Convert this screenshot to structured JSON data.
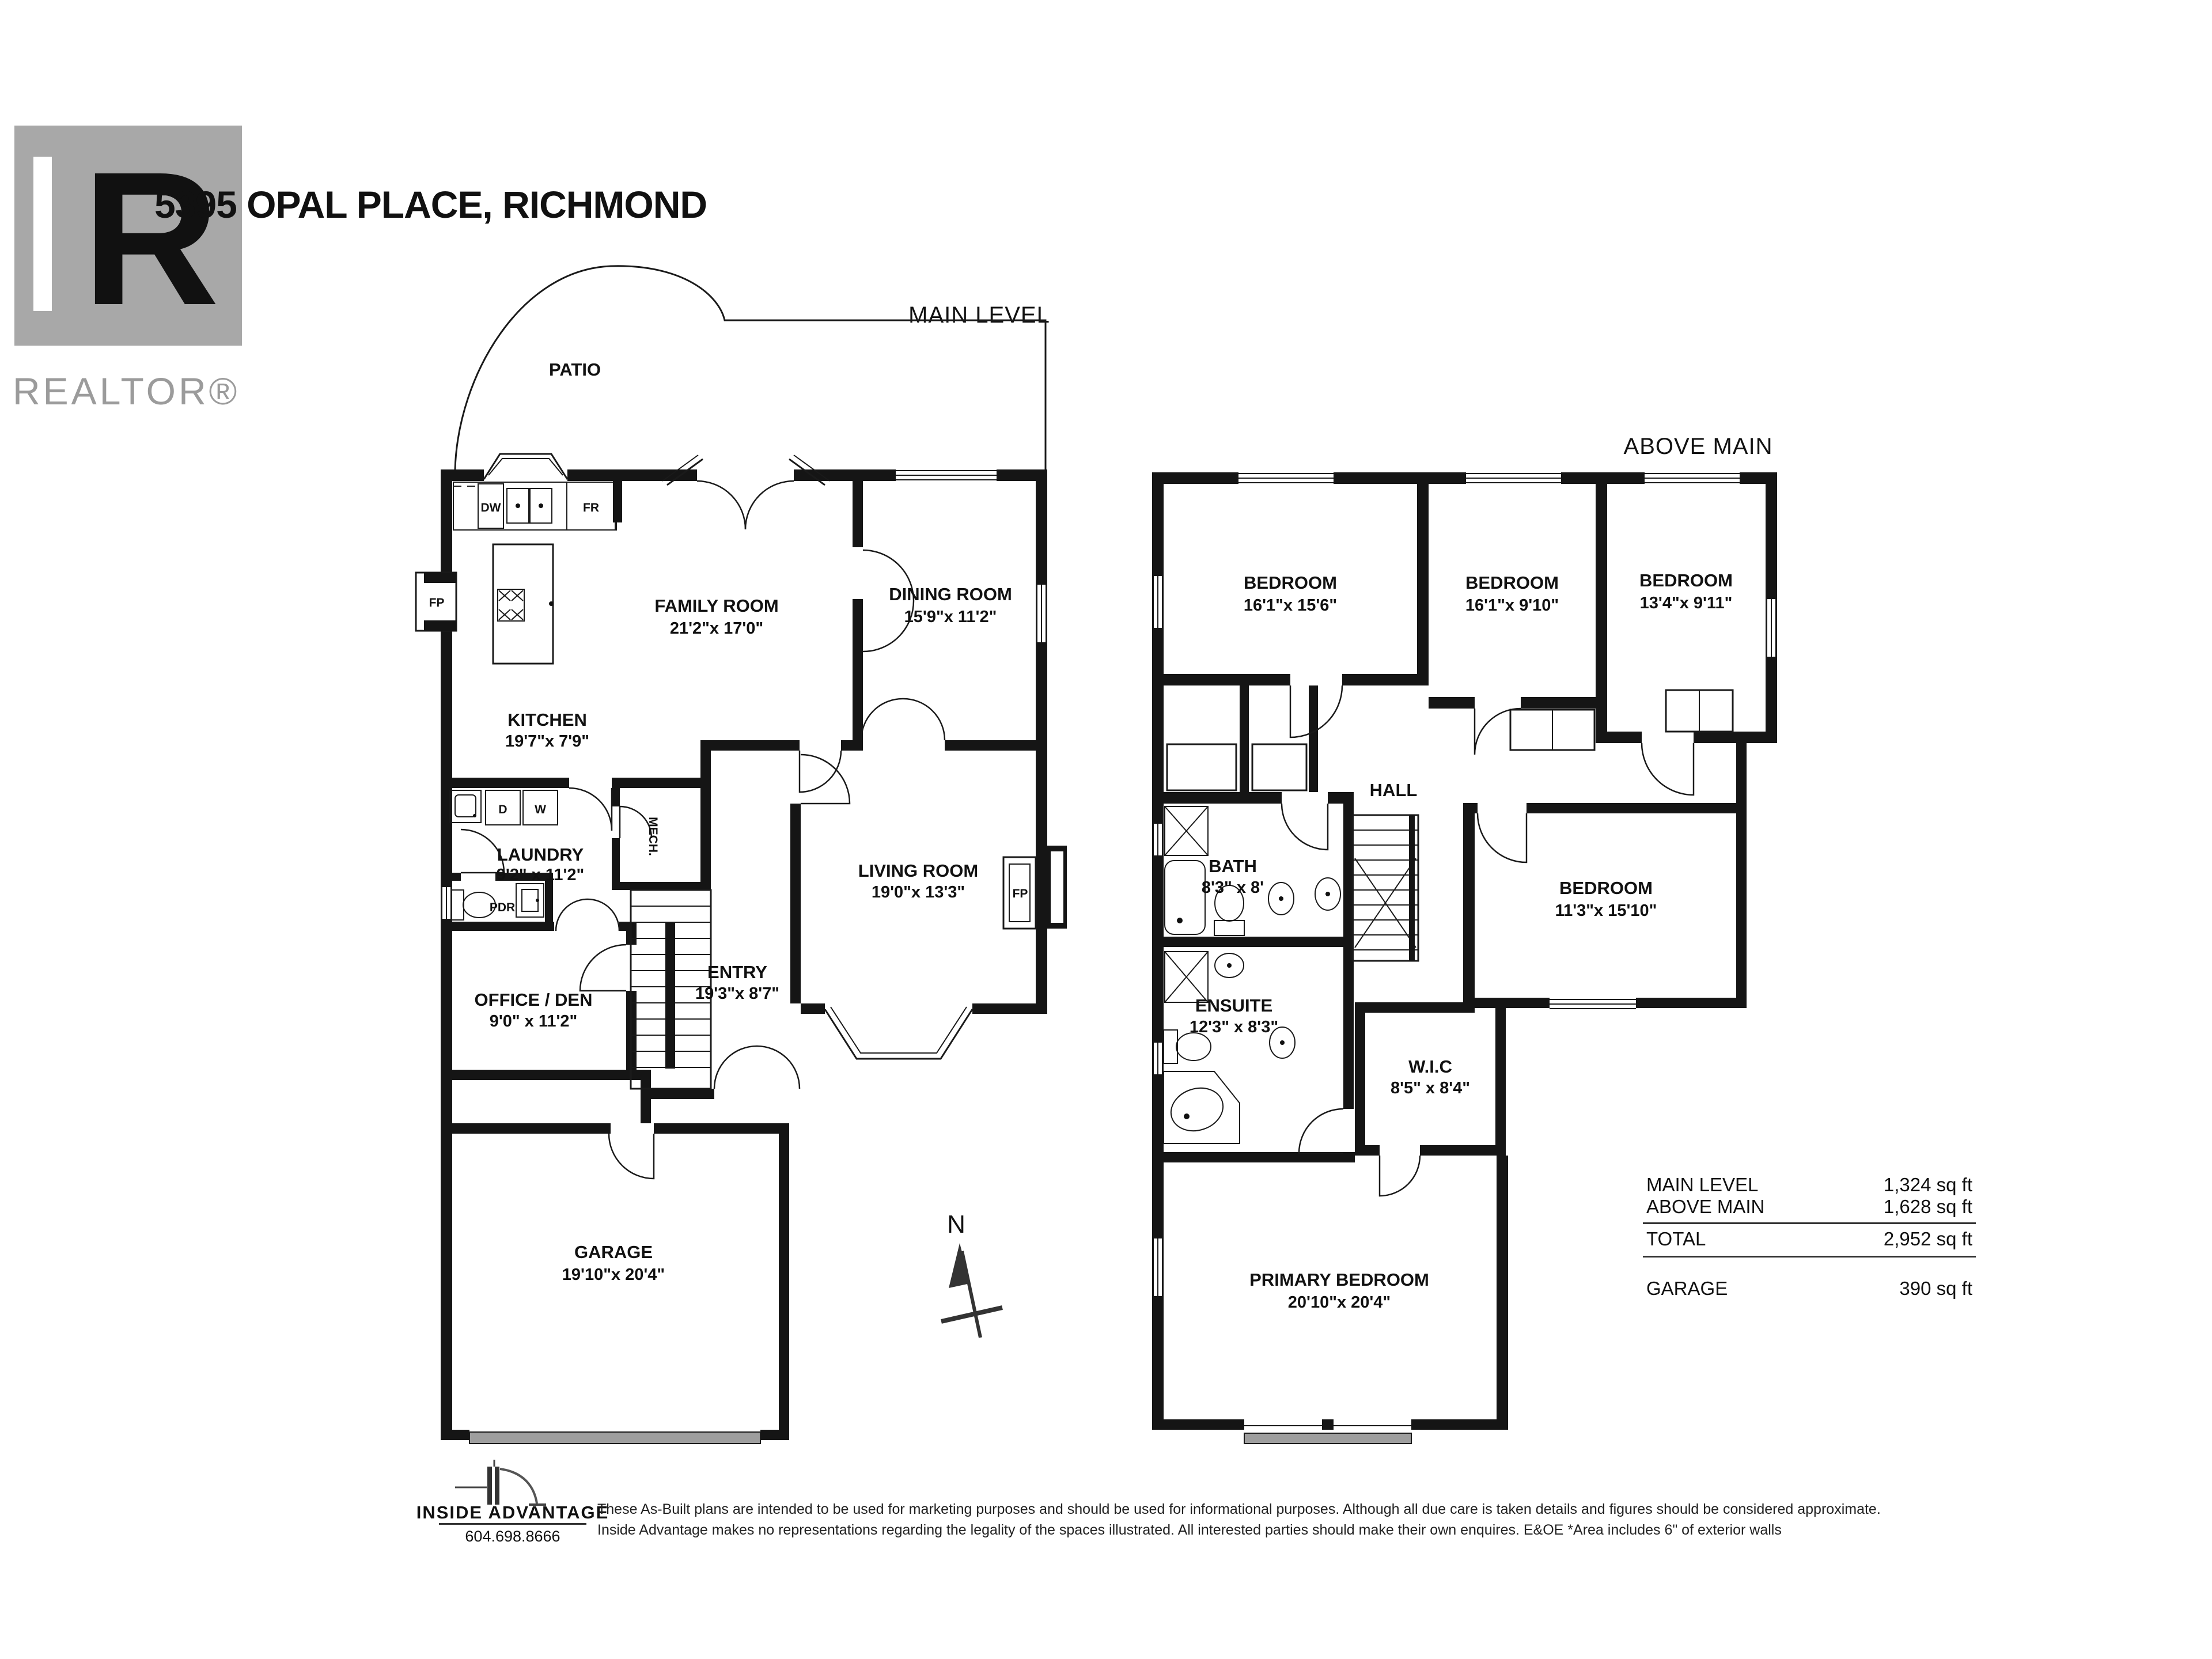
{
  "title": "5395 OPAL PLACE, RICHMOND",
  "realtor": {
    "letter": "R",
    "wordmark": "REALTOR®"
  },
  "main_level": {
    "label": "MAIN LEVEL",
    "patio": "PATIO",
    "family_room": {
      "name": "FAMILY ROOM",
      "dims": "21'2\"x 17'0\""
    },
    "dining_room": {
      "name": "DINING ROOM",
      "dims": "15'9\"x 11'2\""
    },
    "kitchen": {
      "name": "KITCHEN",
      "dims": "19'7\"x 7'9\""
    },
    "laundry": {
      "name": "LAUNDRY",
      "dims": "9'2\" x 11'2\""
    },
    "pdr": "PDR",
    "mech": "MECH.",
    "office_den": {
      "name": "OFFICE / DEN",
      "dims": "9'0\" x 11'2\""
    },
    "entry": {
      "name": "ENTRY",
      "dims": "19'3\"x 8'7\""
    },
    "living_room": {
      "name": "LIVING ROOM",
      "dims": "19'0\"x 13'3\""
    },
    "garage": {
      "name": "GARAGE",
      "dims": "19'10\"x 20'4\""
    },
    "fireplace": "FP",
    "appliances": {
      "dw": "DW",
      "fr": "FR",
      "d": "D",
      "w": "W"
    }
  },
  "above_main": {
    "label": "ABOVE MAIN",
    "bedroom1": {
      "name": "BEDROOM",
      "dims": "16'1\"x 15'6\""
    },
    "bedroom2": {
      "name": "BEDROOM",
      "dims": "16'1\"x 9'10\""
    },
    "bedroom3": {
      "name": "BEDROOM",
      "dims": "13'4\"x 9'11\""
    },
    "bedroom4": {
      "name": "BEDROOM",
      "dims": "11'3\"x 15'10\""
    },
    "hall": "HALL",
    "bath": {
      "name": "BATH",
      "dims": "8'3\" x 8'"
    },
    "ensuite": {
      "name": "ENSUITE",
      "dims": "12'3\" x 8'3\""
    },
    "wic": {
      "name": "W.I.C",
      "dims": "8'5\" x 8'4\""
    },
    "primary_bedroom": {
      "name": "PRIMARY BEDROOM",
      "dims": "20'10\"x 20'4\""
    }
  },
  "north_label": "N",
  "area_table": {
    "row1_label": "MAIN LEVEL",
    "row1_value": "1,324 sq ft",
    "row2_label": "ABOVE MAIN",
    "row2_value": "1,628 sq ft",
    "row3_label": "TOTAL",
    "row3_value": "2,952 sq ft",
    "row4_label": "GARAGE",
    "row4_value": "390 sq ft"
  },
  "footer": {
    "brand": "INSIDE ADVANTAGE",
    "phone": "604.698.8666",
    "disclaimer_line1": "These As-Built plans are intended to be used for marketing purposes and should be used for informational purposes. Although all due care is taken details and figures should be considered approximate.",
    "disclaimer_line2": "Inside Advantage makes no representations regarding the legality of the spaces illustrated.  All interested parties should make their own enquires. E&OE    *Area includes 6\" of exterior walls"
  }
}
